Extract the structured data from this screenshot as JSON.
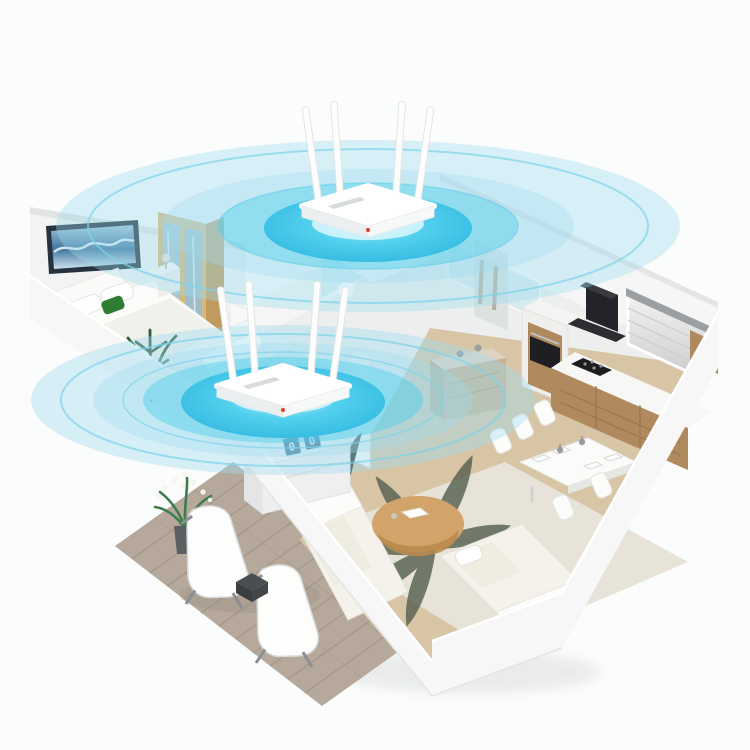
{
  "meta": {
    "description": "Isometric 3D cutaway home render showing two white four-antenna WiFi routers, each emitting concentric cyan signal ripples that cover the rooms of the apartment",
    "visible_text_present": false
  },
  "palette": {
    "background": "#fbfcfc",
    "floor": "#edefee",
    "wall": "#f6f7f6",
    "wall_shade": "#e7e9e8",
    "wood_floor": "#d7c5a5",
    "wood_cabinet": "#b08a5e",
    "wood_wardrobe": "#d9b87e",
    "deck": "#b6a99b",
    "deck_seam": "#a19485",
    "rug": "#e7e3d8",
    "rug_leaf": "#57614f",
    "wifi_glow_core": "#c9f4fc",
    "wifi_glow": "#46cdec",
    "wifi_ring": "#7ed3ea",
    "wifi_tint": "#9fdcef",
    "router_white": "#ffffff",
    "router_accent": "#e0452f",
    "hood_black": "#23242a",
    "plant_green": "#2f5c3a",
    "pillow_green": "#2e7d32",
    "art_frame": "#26323e"
  },
  "scene": {
    "rooms": [
      "master-bedroom",
      "second-bedroom",
      "glass-bathroom",
      "hallway",
      "kitchen",
      "dining-area",
      "living-room",
      "patio-deck"
    ],
    "furniture": [
      "wave-wall-art",
      "double-bed",
      "green-accent-pillow",
      "nightstand-lamp",
      "mirrored-wardrobe",
      "potted-palm",
      "second-bed",
      "glass-shower-panels",
      "hallway-sideboard",
      "range-hood",
      "oven-column",
      "cooktop",
      "kitchen-counter",
      "roman-shade-window",
      "upper-cabinet",
      "dining-table",
      "dining-chairs",
      "table-centerpieces",
      "sofa-left",
      "sofa-right",
      "round-coffee-table",
      "leaf-pattern-rug",
      "floor-plant",
      "flip-clock-dresser",
      "lounge-chair",
      "lounge-chair",
      "patio-side-table",
      "patio-flower-pot"
    ]
  },
  "routers": [
    {
      "id": "router-top",
      "room": "glass-bathroom",
      "antennas": 4,
      "ripple_rings": 3,
      "body_color": "#ffffff"
    },
    {
      "id": "router-bottom",
      "room": "second-bedroom-hallway",
      "antennas": 4,
      "ripple_rings": 3,
      "body_color": "#ffffff"
    }
  ],
  "clock": {
    "digits": [
      "0",
      "0"
    ]
  }
}
